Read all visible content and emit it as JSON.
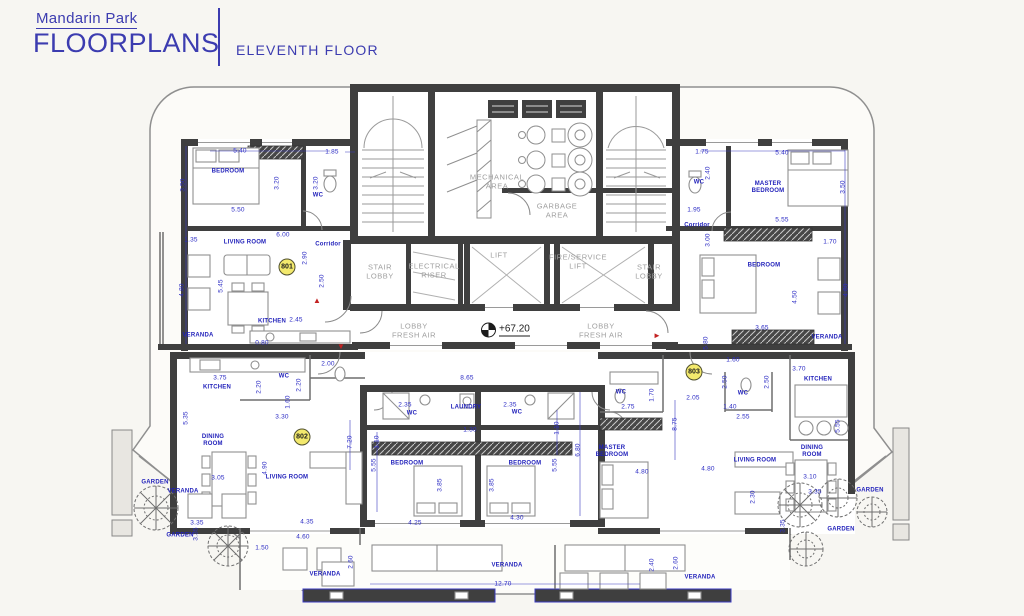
{
  "title_block": {
    "project": "Mandarin Park",
    "title": "FLOORPLANS",
    "floor": "ELEVENTH FLOOR"
  },
  "level_marker": {
    "value": "+67.20",
    "x": 481,
    "y": 330
  },
  "apartment_badges": [
    {
      "t": "801",
      "x": 287,
      "y": 267
    },
    {
      "t": "802",
      "x": 302,
      "y": 437
    },
    {
      "t": "803",
      "x": 694,
      "y": 372
    }
  ],
  "core_labels": [
    {
      "t": "MECHANICAL\nAREA",
      "x": 497,
      "y": 182
    },
    {
      "t": "GARBAGE\nAREA",
      "x": 557,
      "y": 211
    },
    {
      "t": "STAIR\nLOBBY",
      "x": 380,
      "y": 272
    },
    {
      "t": "ELECTRICAL\nRISER",
      "x": 434,
      "y": 271
    },
    {
      "t": "LIFT",
      "x": 499,
      "y": 256
    },
    {
      "t": "FIRE/SERVICE\nLIFT",
      "x": 578,
      "y": 262
    },
    {
      "t": "STAIR\nLOBBY",
      "x": 649,
      "y": 272
    },
    {
      "t": "LOBBY\nFRESH AIR",
      "x": 414,
      "y": 331
    },
    {
      "t": "LOBBY\nFRESH AIR",
      "x": 601,
      "y": 331
    }
  ],
  "room_labels": [
    {
      "t": "BEDROOM",
      "x": 228,
      "y": 172
    },
    {
      "t": "WC",
      "x": 318,
      "y": 196
    },
    {
      "t": "LIVING ROOM",
      "x": 245,
      "y": 243
    },
    {
      "t": "Corridor",
      "x": 328,
      "y": 245
    },
    {
      "t": "KITCHEN",
      "x": 272,
      "y": 322
    },
    {
      "t": "VERANDA",
      "x": 198,
      "y": 336
    },
    {
      "t": "WC",
      "x": 699,
      "y": 183
    },
    {
      "t": "MASTER\nBEDROOM",
      "x": 768,
      "y": 188
    },
    {
      "t": "Corridor",
      "x": 697,
      "y": 226
    },
    {
      "t": "BEDROOM",
      "x": 764,
      "y": 266
    },
    {
      "t": "VERANDA",
      "x": 827,
      "y": 338
    },
    {
      "t": "KITCHEN",
      "x": 818,
      "y": 380
    },
    {
      "t": "KITCHEN",
      "x": 217,
      "y": 388
    },
    {
      "t": "WC",
      "x": 284,
      "y": 377
    },
    {
      "t": "DINING\nROOM",
      "x": 213,
      "y": 441
    },
    {
      "t": "LIVING ROOM",
      "x": 287,
      "y": 478
    },
    {
      "t": "VERANDA",
      "x": 183,
      "y": 492
    },
    {
      "t": "GARDEN",
      "x": 155,
      "y": 483
    },
    {
      "t": "GARDEN",
      "x": 180,
      "y": 536
    },
    {
      "t": "WC",
      "x": 412,
      "y": 414
    },
    {
      "t": "LAUNDRY",
      "x": 466,
      "y": 408
    },
    {
      "t": "WC",
      "x": 517,
      "y": 413
    },
    {
      "t": "BEDROOM",
      "x": 407,
      "y": 464
    },
    {
      "t": "BEDROOM",
      "x": 525,
      "y": 464
    },
    {
      "t": "WC",
      "x": 621,
      "y": 393
    },
    {
      "t": "WC",
      "x": 743,
      "y": 394
    },
    {
      "t": "MASTER\nBEDROOM",
      "x": 612,
      "y": 452
    },
    {
      "t": "LIVING ROOM",
      "x": 755,
      "y": 461
    },
    {
      "t": "DINING\nROOM",
      "x": 812,
      "y": 452
    },
    {
      "t": "GARDEN",
      "x": 870,
      "y": 491
    },
    {
      "t": "GARDEN",
      "x": 841,
      "y": 530
    },
    {
      "t": "VERANDA",
      "x": 325,
      "y": 575
    },
    {
      "t": "VERANDA",
      "x": 507,
      "y": 566
    },
    {
      "t": "VERANDA",
      "x": 700,
      "y": 578
    }
  ],
  "dimensions": [
    {
      "t": "5.40",
      "x": 240,
      "y": 151
    },
    {
      "t": "1.85",
      "x": 332,
      "y": 152
    },
    {
      "t": "5.50",
      "x": 238,
      "y": 210
    },
    {
      "t": "1.35",
      "x": 191,
      "y": 240
    },
    {
      "t": "6.00",
      "x": 283,
      "y": 235
    },
    {
      "t": "2.45",
      "x": 296,
      "y": 320
    },
    {
      "t": "0.80",
      "x": 262,
      "y": 343
    },
    {
      "t": "1.75",
      "x": 702,
      "y": 152
    },
    {
      "t": "5.40",
      "x": 782,
      "y": 153
    },
    {
      "t": "1.95",
      "x": 694,
      "y": 210
    },
    {
      "t": "5.55",
      "x": 782,
      "y": 220
    },
    {
      "t": "1.70",
      "x": 830,
      "y": 242
    },
    {
      "t": "3.65",
      "x": 762,
      "y": 328
    },
    {
      "t": "3.70",
      "x": 799,
      "y": 369
    },
    {
      "t": "2.00",
      "x": 328,
      "y": 364
    },
    {
      "t": "3.75",
      "x": 220,
      "y": 378
    },
    {
      "t": "3.30",
      "x": 282,
      "y": 417
    },
    {
      "t": "3.05",
      "x": 218,
      "y": 478
    },
    {
      "t": "8.65",
      "x": 467,
      "y": 378
    },
    {
      "t": "2.35",
      "x": 405,
      "y": 405
    },
    {
      "t": "2.35",
      "x": 510,
      "y": 405
    },
    {
      "t": "1.30",
      "x": 470,
      "y": 430
    },
    {
      "t": "4.25",
      "x": 415,
      "y": 523
    },
    {
      "t": "4.30",
      "x": 517,
      "y": 518
    },
    {
      "t": "1.60",
      "x": 733,
      "y": 360
    },
    {
      "t": "2.05",
      "x": 693,
      "y": 398
    },
    {
      "t": "2.75",
      "x": 628,
      "y": 407
    },
    {
      "t": "1.40",
      "x": 730,
      "y": 407
    },
    {
      "t": "2.55",
      "x": 743,
      "y": 417
    },
    {
      "t": "4.80",
      "x": 642,
      "y": 472
    },
    {
      "t": "4.80",
      "x": 708,
      "y": 469
    },
    {
      "t": "3.10",
      "x": 810,
      "y": 477
    },
    {
      "t": "3.35",
      "x": 815,
      "y": 492
    },
    {
      "t": "3.35",
      "x": 197,
      "y": 523
    },
    {
      "t": "1.50",
      "x": 262,
      "y": 548
    },
    {
      "t": "4.35",
      "x": 307,
      "y": 522
    },
    {
      "t": "4.60",
      "x": 303,
      "y": 537
    },
    {
      "t": "12.70",
      "x": 503,
      "y": 584
    },
    {
      "t": "3.50",
      "x": 183,
      "y": 185,
      "cls": "vert"
    },
    {
      "t": "3.20",
      "x": 277,
      "y": 183,
      "cls": "vert"
    },
    {
      "t": "3.20",
      "x": 316,
      "y": 183,
      "cls": "vert"
    },
    {
      "t": "2.90",
      "x": 305,
      "y": 258,
      "cls": "vert"
    },
    {
      "t": "2.50",
      "x": 322,
      "y": 281,
      "cls": "vert"
    },
    {
      "t": "5.45",
      "x": 221,
      "y": 286,
      "cls": "vert"
    },
    {
      "t": "4.80",
      "x": 182,
      "y": 290,
      "cls": "vert"
    },
    {
      "t": "2.40",
      "x": 708,
      "y": 173,
      "cls": "vert"
    },
    {
      "t": "3.50",
      "x": 843,
      "y": 187,
      "cls": "vert"
    },
    {
      "t": "3.00",
      "x": 708,
      "y": 240,
      "cls": "vert"
    },
    {
      "t": "4.50",
      "x": 795,
      "y": 297,
      "cls": "vert"
    },
    {
      "t": "4.80",
      "x": 846,
      "y": 290,
      "cls": "vert"
    },
    {
      "t": "5.80",
      "x": 706,
      "y": 343,
      "cls": "vert"
    },
    {
      "t": "5.55",
      "x": 838,
      "y": 426,
      "cls": "vert"
    },
    {
      "t": "2.20",
      "x": 259,
      "y": 387,
      "cls": "vert"
    },
    {
      "t": "2.20",
      "x": 299,
      "y": 385,
      "cls": "vert"
    },
    {
      "t": "1.60",
      "x": 288,
      "y": 402,
      "cls": "vert"
    },
    {
      "t": "5.35",
      "x": 186,
      "y": 418,
      "cls": "vert"
    },
    {
      "t": "7.20",
      "x": 350,
      "y": 442,
      "cls": "vert"
    },
    {
      "t": "4.90",
      "x": 265,
      "y": 468,
      "cls": "vert"
    },
    {
      "t": "1.10",
      "x": 377,
      "y": 442,
      "cls": "vert"
    },
    {
      "t": "1.10",
      "x": 557,
      "y": 428,
      "cls": "vert"
    },
    {
      "t": "5.55",
      "x": 374,
      "y": 465,
      "cls": "vert"
    },
    {
      "t": "5.55",
      "x": 555,
      "y": 465,
      "cls": "vert"
    },
    {
      "t": "3.85",
      "x": 440,
      "y": 485,
      "cls": "vert"
    },
    {
      "t": "3.85",
      "x": 492,
      "y": 485,
      "cls": "vert"
    },
    {
      "t": "6.80",
      "x": 578,
      "y": 450,
      "cls": "vert"
    },
    {
      "t": "2.50",
      "x": 725,
      "y": 382,
      "cls": "vert"
    },
    {
      "t": "2.50",
      "x": 767,
      "y": 382,
      "cls": "vert"
    },
    {
      "t": "1.70",
      "x": 652,
      "y": 395,
      "cls": "vert"
    },
    {
      "t": "8.75",
      "x": 675,
      "y": 424,
      "cls": "vert"
    },
    {
      "t": "2.30",
      "x": 753,
      "y": 497,
      "cls": "vert"
    },
    {
      "t": "3.35",
      "x": 783,
      "y": 526,
      "cls": "vert"
    },
    {
      "t": "3.35",
      "x": 196,
      "y": 534,
      "cls": "vert"
    },
    {
      "t": "2.60",
      "x": 351,
      "y": 562,
      "cls": "vert"
    },
    {
      "t": "2.40",
      "x": 652,
      "y": 565,
      "cls": "vert"
    },
    {
      "t": "2.60",
      "x": 676,
      "y": 563,
      "cls": "vert"
    }
  ],
  "entry_markers": [
    {
      "t": "▲",
      "x": 317,
      "y": 301
    },
    {
      "t": "▼",
      "x": 341,
      "y": 347
    },
    {
      "t": "►",
      "x": 657,
      "y": 336
    }
  ]
}
